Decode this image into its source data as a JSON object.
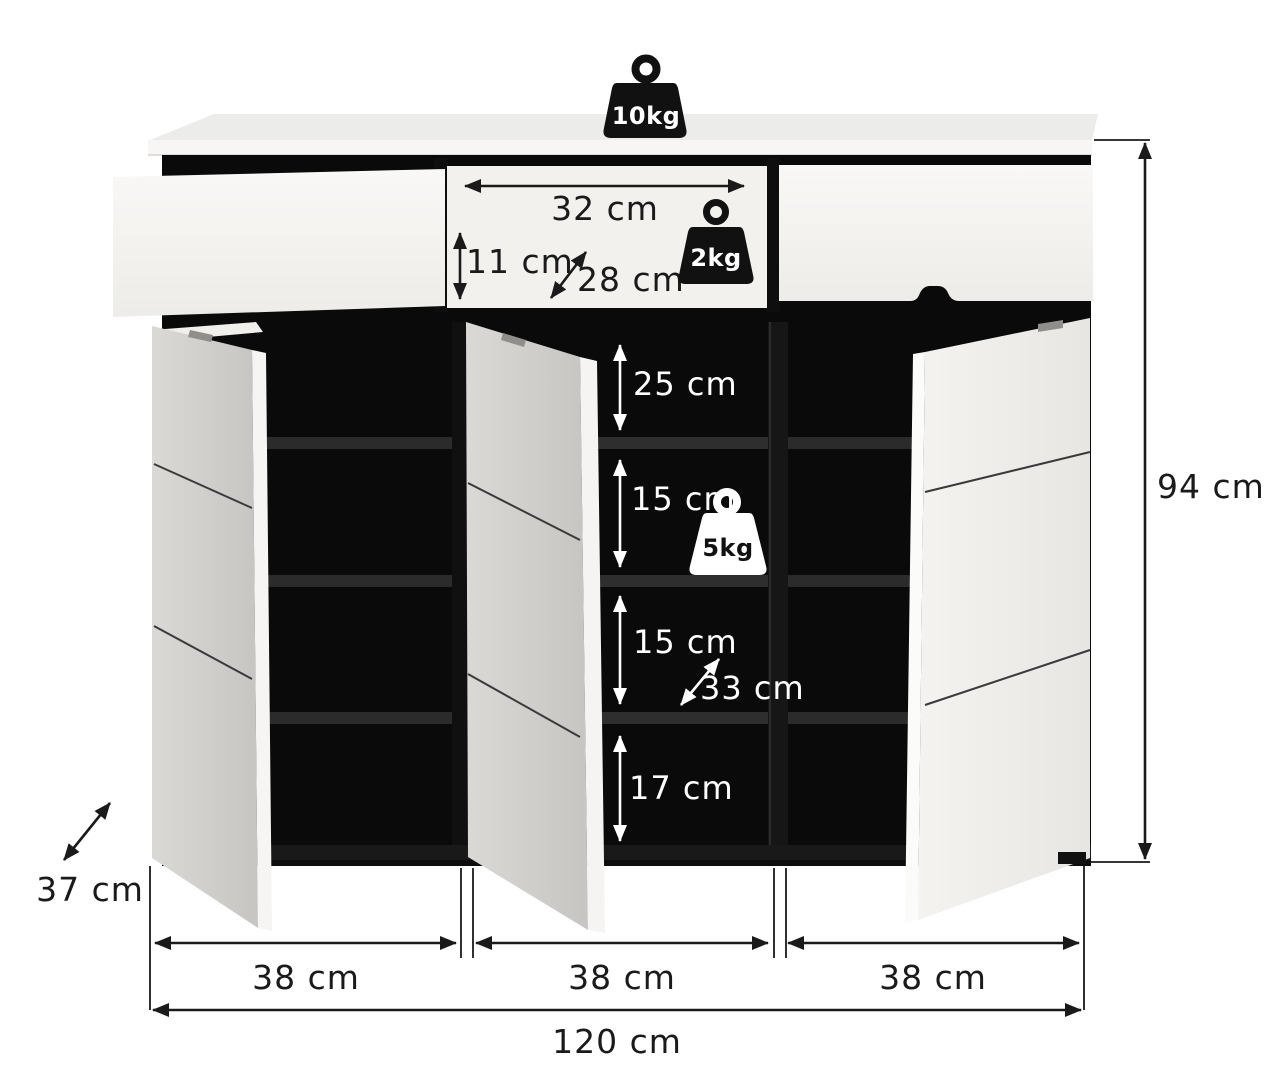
{
  "title": "Shoe cabinet dimension diagram",
  "units": "cm",
  "colors": {
    "background": "#ffffff",
    "cabinet_white": "#f7f6f4",
    "door_gray": "#d2d1ce",
    "interior_black": "#0a0a0a",
    "annotation_black": "#1a1a1a",
    "annotation_white": "#ffffff"
  },
  "load_labels": {
    "top_load": "10kg",
    "drawer_load": "2kg",
    "shelf_load": "5kg"
  },
  "dimension_labels": {
    "drawer_width": "32 cm",
    "drawer_front_height": "11 cm",
    "drawer_depth": "28 cm",
    "compartment_top_height": "25 cm",
    "compartment_upper_mid_height": "15 cm",
    "compartment_lower_mid_height": "15 cm",
    "compartment_bottom_height": "17 cm",
    "interior_depth": "33 cm",
    "overall_height": "94 cm",
    "overall_depth": "37 cm",
    "section1_width": "38 cm",
    "section2_width": "38 cm",
    "section3_width": "38 cm",
    "overall_width": "120 cm"
  }
}
